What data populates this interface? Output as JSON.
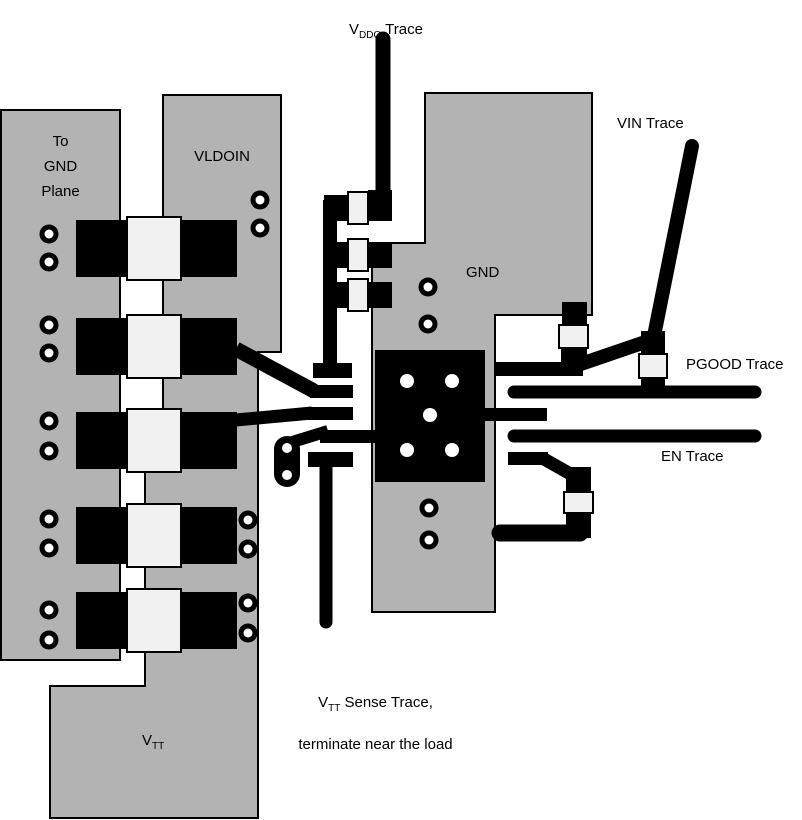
{
  "colors": {
    "plane": "#b3b3b3",
    "pad": "#f1f1f1",
    "copper": "#000000",
    "background": "#ffffff",
    "outline": "#000000"
  },
  "labels": {
    "vddq": {
      "pre": "V",
      "sub": "DDQ",
      "post": " Trace"
    },
    "vin": "VIN Trace",
    "pgood": "PGOOD Trace",
    "en": "EN Trace",
    "gnd": "GND",
    "vldoin": "VLDOIN",
    "to_gnd_plane": "To\nGND\nPlane",
    "vtt": {
      "pre": "V",
      "sub": "TT"
    },
    "vtt_sense": {
      "pre": "V",
      "sub": "TT",
      "post": " Sense Trace,",
      "line2": "terminate near the load"
    }
  }
}
